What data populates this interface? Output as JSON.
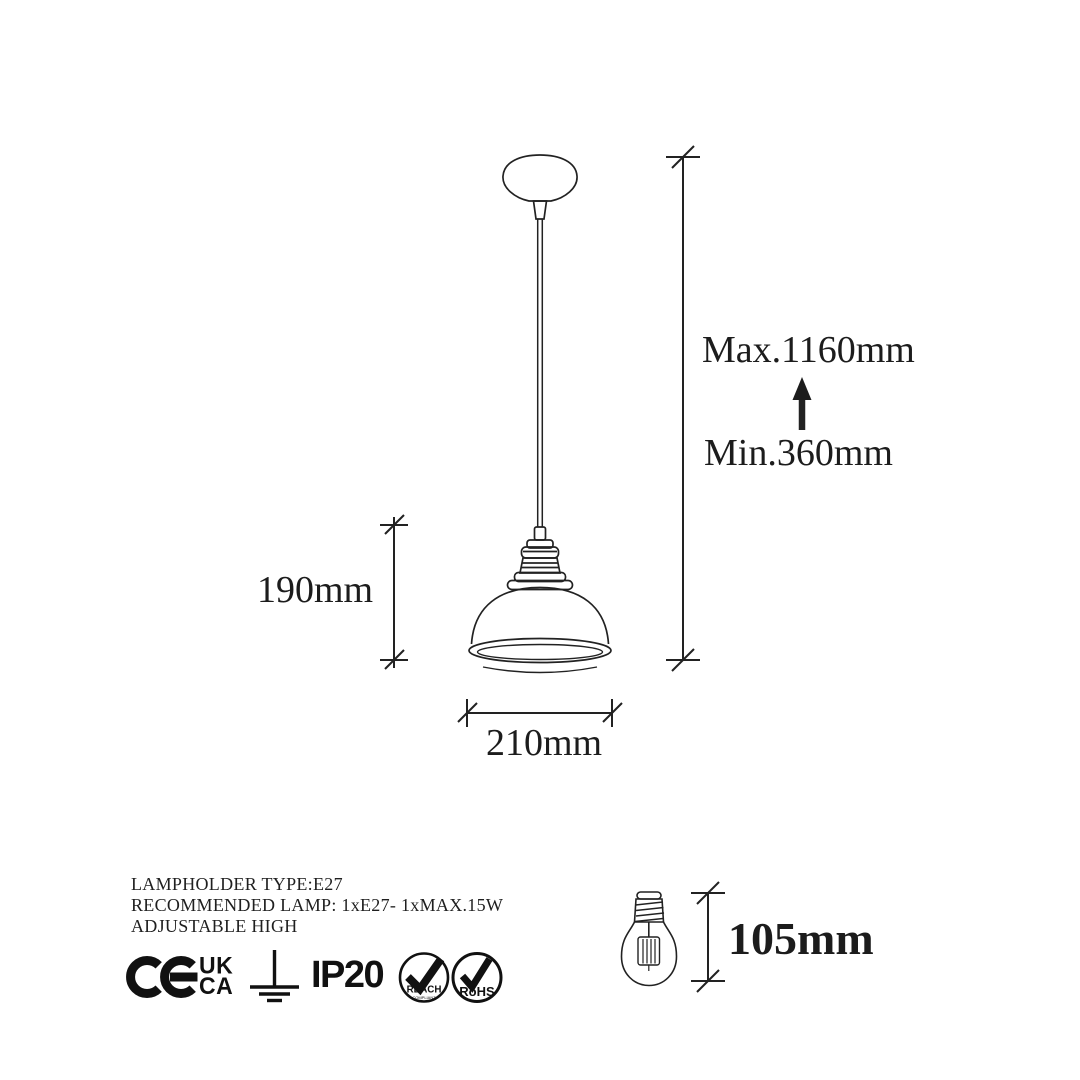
{
  "page": {
    "background": "#ffffff",
    "ink_color": "#1c1c1c",
    "description": "Pendant lamp technical dimension sheet"
  },
  "dimensions": {
    "max_label": "Max.1160mm",
    "min_label": "Min.360mm",
    "shade_height": "190mm",
    "shade_diameter": "210mm",
    "bulb_height": "105mm"
  },
  "specs": {
    "line1": "LAMPHOLDER TYPE:E27",
    "line2": "RECOMMENDED LAMP: 1xE27- 1xMAX.15W",
    "line3": "ADJUSTABLE HIGH"
  },
  "certifications": {
    "ce": "CE",
    "ukca_top": "UK",
    "ukca_bottom": "CA",
    "ip_rating": "IP20",
    "reach_label": "REACH",
    "reach_sub": "COMPLIANT",
    "rohs_label": "RoHS"
  },
  "icons": [
    "ce-mark-icon",
    "ukca-icon",
    "ground-symbol-icon",
    "reach-badge-icon",
    "rohs-badge-icon",
    "height-adjust-arrow-icon"
  ]
}
